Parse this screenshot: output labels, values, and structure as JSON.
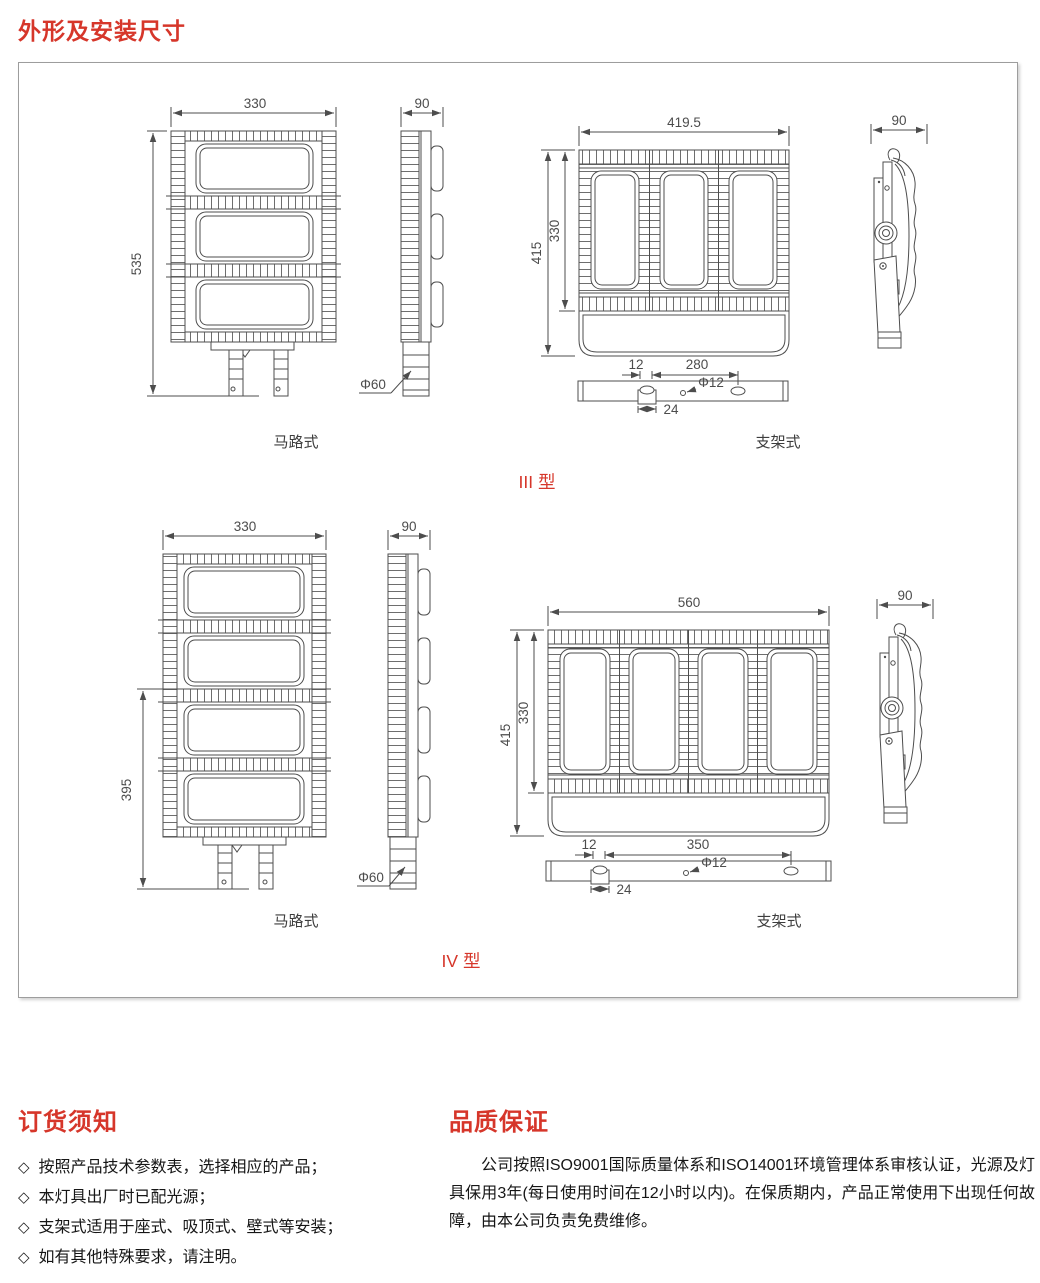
{
  "page": {
    "title": "外形及安装尺寸"
  },
  "diagram": {
    "type3": {
      "label": "III 型",
      "road_view_label": "马路式",
      "bracket_view_label": "支架式",
      "road_front": {
        "width": "330",
        "height": "535"
      },
      "road_side": {
        "width": "90",
        "pole_diameter": "Φ60"
      },
      "bracket_front": {
        "width": "419.5",
        "height_total": "415",
        "height_body": "330"
      },
      "bracket_side": {
        "width": "90"
      },
      "mount": {
        "edge_offset": "12",
        "hole_spacing": "280",
        "hole_diameter": "Φ12",
        "slot_width": "24"
      }
    },
    "type4": {
      "label": "IV 型",
      "road_view_label": "马路式",
      "bracket_view_label": "支架式",
      "road_front": {
        "width": "330",
        "height": "395"
      },
      "road_side": {
        "width": "90",
        "pole_diameter": "Φ60"
      },
      "bracket_front": {
        "width": "560",
        "height_total": "415",
        "height_body": "330"
      },
      "bracket_side": {
        "width": "90"
      },
      "mount": {
        "edge_offset": "12",
        "hole_spacing": "350",
        "hole_diameter": "Φ12",
        "slot_width": "24"
      }
    }
  },
  "ordering": {
    "title": "订货须知",
    "bullet": "◇",
    "items": [
      "按照产品技术参数表，选择相应的产品；",
      "本灯具出厂时已配光源；",
      "支架式适用于座式、吸顶式、壁式等安装；",
      "如有其他特殊要求，请注明。"
    ]
  },
  "quality": {
    "title": "品质保证",
    "body": "公司按照ISO9001国际质量体系和ISO14001环境管理体系审核认证，光源及灯具保用3年(每日使用时间在12小时以内)。在保质期内，产品正常使用下出现任何故障，由本公司负责免费维修。"
  },
  "colors": {
    "accent_red": "#d6362a",
    "line_gray": "#4d4d4d"
  }
}
